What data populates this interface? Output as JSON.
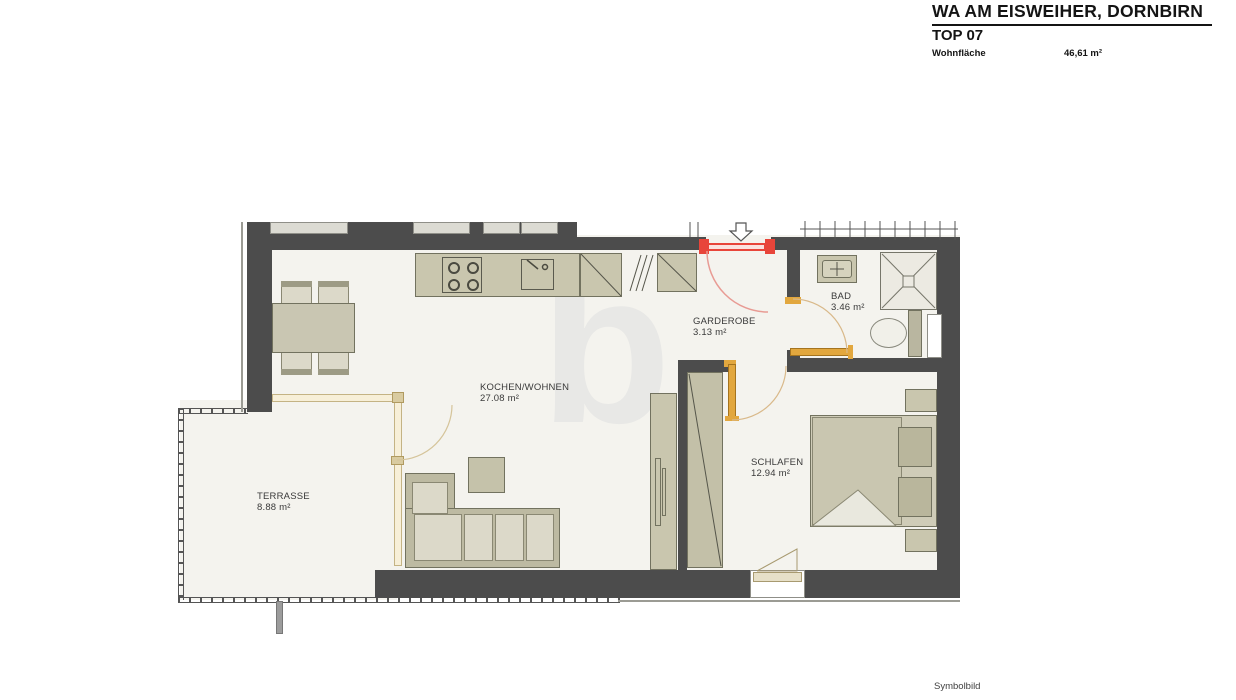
{
  "header": {
    "project_title": "WA AM EISWEIHER, DORNBIRN",
    "unit_title": "TOP 07",
    "area_label": "Wohnfläche",
    "area_value": "46,61 m²"
  },
  "footer": {
    "note": "Symbolbild"
  },
  "watermark_letter": "b",
  "rooms": [
    {
      "name": "KOCHEN/WOHNEN",
      "area": "27.08 m²"
    },
    {
      "name": "GARDEROBE",
      "area": "3.13 m²"
    },
    {
      "name": "BAD",
      "area": "3.46 m²"
    },
    {
      "name": "SCHLAFEN",
      "area": "12.94 m²"
    },
    {
      "name": "TERRASSE",
      "area": "8.88 m²"
    }
  ],
  "colors": {
    "wall": "#4c4c4c",
    "floor": "#f4f3ee",
    "furniture": "#c9c6ae",
    "entrance_door": "#e8453a",
    "interior_door": "#e2a73e",
    "glass_wall": "#f7efd8"
  }
}
